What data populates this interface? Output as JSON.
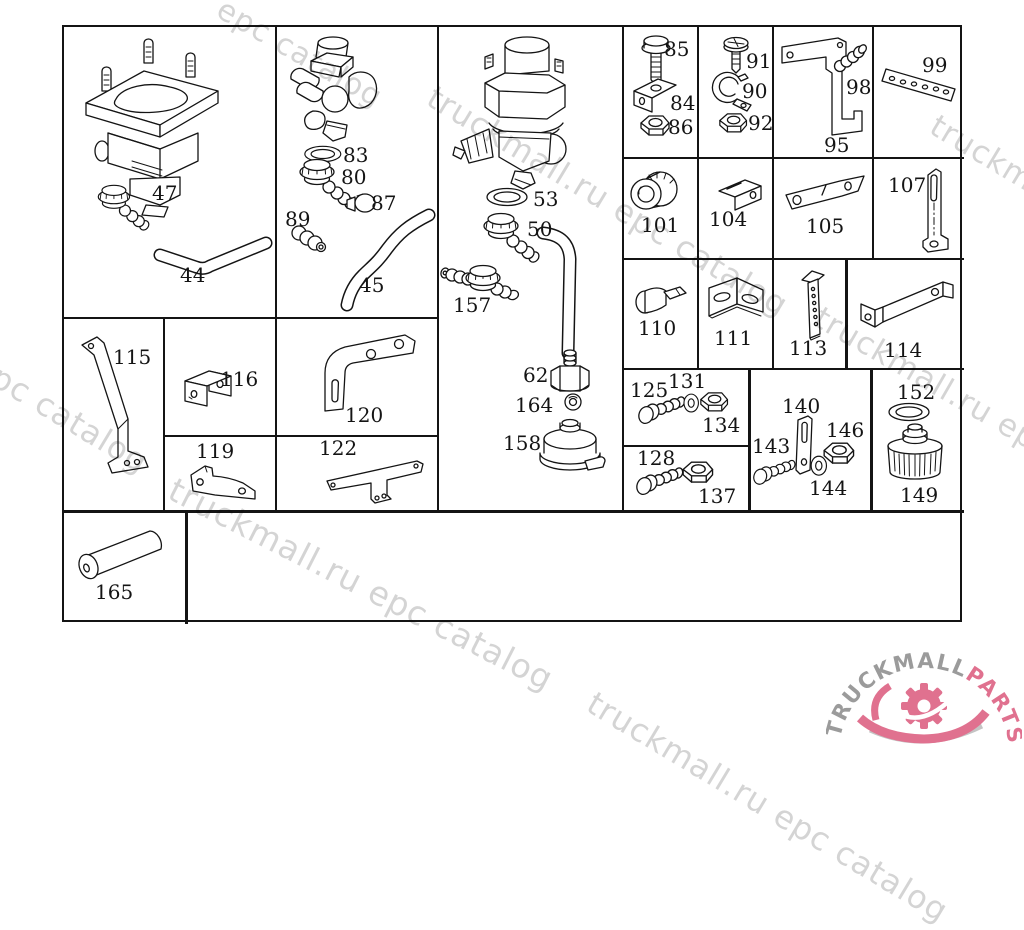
{
  "parts": {
    "44": "44",
    "45": "45",
    "47": "47",
    "50": "50",
    "53": "53",
    "62": "62",
    "80": "80",
    "83": "83",
    "84": "84",
    "85": "85",
    "86": "86",
    "87": "87",
    "89": "89",
    "90": "90",
    "91": "91",
    "92": "92",
    "95": "95",
    "98": "98",
    "99": "99",
    "101": "101",
    "104": "104",
    "105": "105",
    "107": "107",
    "110": "110",
    "111": "111",
    "113": "113",
    "114": "114",
    "115": "115",
    "116": "116",
    "119": "119",
    "120": "120",
    "122": "122",
    "125": "125",
    "128": "128",
    "131": "131",
    "134": "134",
    "137": "137",
    "140": "140",
    "143": "143",
    "144": "144",
    "146": "146",
    "149": "149",
    "152": "152",
    "157": "157",
    "158": "158",
    "164": "164",
    "165": "165"
  },
  "watermarks": [
    {
      "text": "epc catalog"
    },
    {
      "text": "truckmall.ru epc catalog"
    },
    {
      "text": "truckmall.ru epc catalog"
    },
    {
      "text": "truckmall.ru epc catalog"
    },
    {
      "text": "truckmall.ru epc catalog"
    },
    {
      "text": "truckmall.ru epc catalog"
    },
    {
      "text": "truckmall.ru epc catalog"
    }
  ],
  "logo": {
    "gray": "TRUCKMALL",
    "pink": "PARTS"
  },
  "colors": {
    "line": "#141414",
    "watermark": "#d4d4d4",
    "logo_gray": "#9b9b9b",
    "logo_pink": "#e0718f"
  }
}
